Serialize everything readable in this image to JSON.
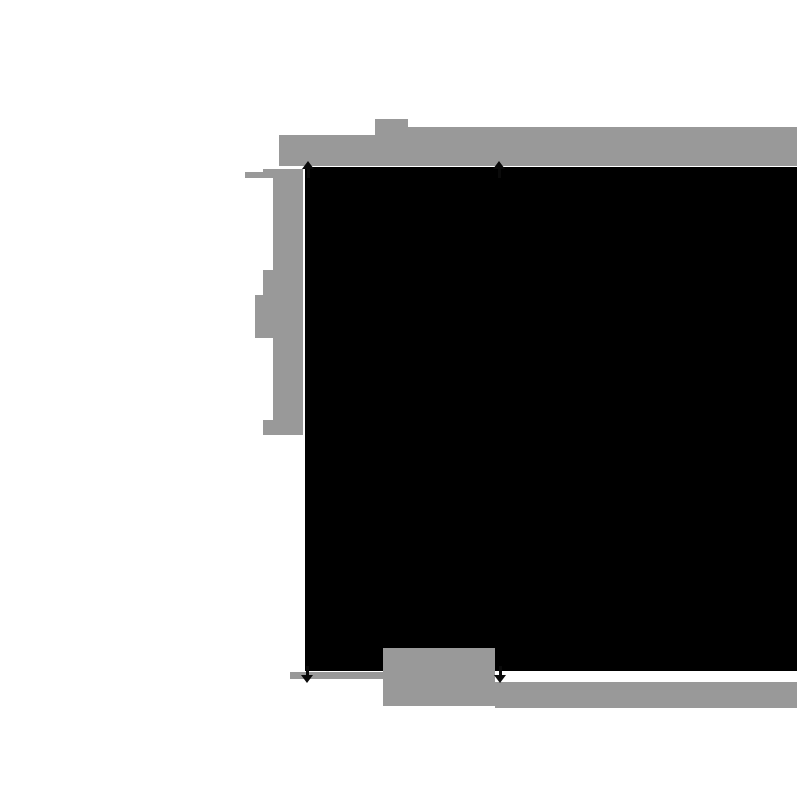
{
  "figure": {
    "description": "Pixelated diagram: solid black rectangle annotated with blurred gray label bars (top, left, bottom) and four black dimension arrowheads marking the inner span",
    "background": "#ffffff",
    "colors": {
      "annotation": "#999999",
      "content": "#000000",
      "arrow": "#0a0a0a"
    },
    "blocks": [
      {
        "name": "top-annotation-bar-left-segment"
      },
      {
        "name": "top-annotation-text-blob"
      },
      {
        "name": "top-annotation-bar-right-segment"
      },
      {
        "name": "left-annotation-stub"
      },
      {
        "name": "left-annotation-bar"
      },
      {
        "name": "left-bracket-serif-top"
      },
      {
        "name": "left-label-blob-small"
      },
      {
        "name": "left-label-blob-large"
      },
      {
        "name": "left-bracket-serif-bottom"
      },
      {
        "name": "black-content-rectangle"
      },
      {
        "name": "bottom-label-blob"
      },
      {
        "name": "bottom-annotation-strip-left"
      },
      {
        "name": "bottom-annotation-bar-right"
      }
    ],
    "arrows": [
      {
        "name": "top-left",
        "direction": "up"
      },
      {
        "name": "top-right",
        "direction": "up"
      },
      {
        "name": "bottom-left",
        "direction": "down"
      },
      {
        "name": "bottom-right",
        "direction": "down"
      }
    ]
  }
}
